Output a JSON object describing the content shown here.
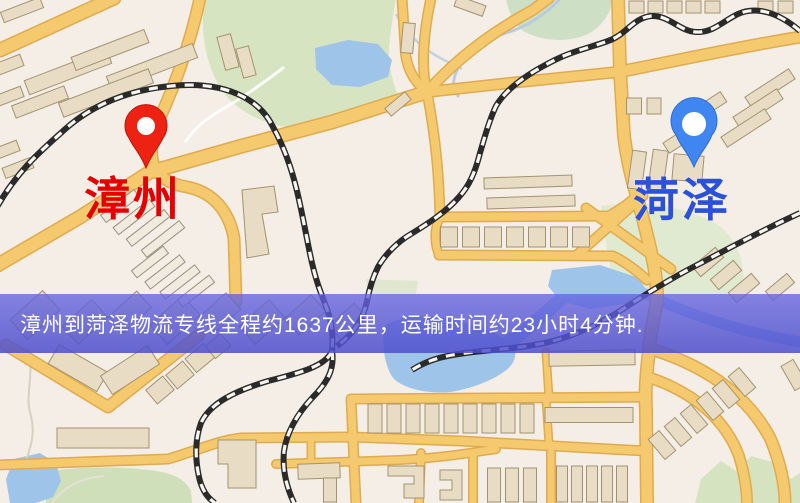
{
  "map": {
    "origin": {
      "label": "漳州",
      "label_color": "#e60000",
      "pin_color": "#ee2213"
    },
    "destination": {
      "label": "菏泽",
      "label_color": "#2b50d9",
      "pin_color": "#3f86f0"
    }
  },
  "banner": {
    "text": "漳州到菏泽物流专线全程约1637公里，运输时间约23小时4分钟.",
    "distance_km": "1637",
    "transit_time": "23小时4分钟",
    "background_color": "#5c5cd4",
    "text_color": "#ffffff"
  },
  "palette": {
    "map_background": "#f4eee6",
    "road_fill": "#f5ca6e",
    "road_casing": "#e0aa4e",
    "park_green": "#d7e4c1",
    "water_blue": "#9ec4ea",
    "building_beige": "#e8ddc4",
    "railway_dark": "#2a2a2a"
  }
}
